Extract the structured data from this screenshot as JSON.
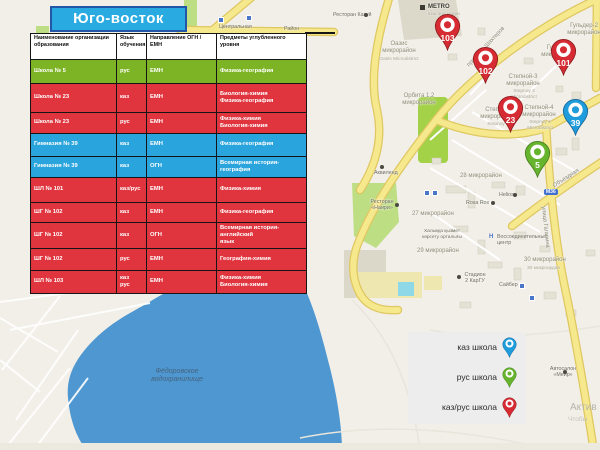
{
  "title": "Юго-восток",
  "table": {
    "headers": [
      "Наименование организации образования",
      "Язык обучения",
      "Направление ОГН /ЕМН",
      "Предметы углубленного уровня"
    ],
    "rows": [
      {
        "name": "Школа № 5",
        "lang": "рус",
        "direction": "ЕМН",
        "subjects": "Физика-география",
        "color": "green"
      },
      {
        "name": "Школа № 23",
        "lang": "каз",
        "direction": "ЕМН",
        "subjects": "Биология-химия\nФизика-география",
        "color": "red"
      },
      {
        "name": "Школа № 23",
        "lang": "рус",
        "direction": "ЕМН",
        "subjects": "Физика-химия\nБиология-химия",
        "color": "red"
      },
      {
        "name": "Гимназия № 39",
        "lang": "каз",
        "direction": "ЕМН",
        "subjects": "Физика-география",
        "color": "blue"
      },
      {
        "name": "Гимназия № 39",
        "lang": "каз",
        "direction": "ОГН",
        "subjects": "Всемирная история-география",
        "color": "blue"
      },
      {
        "name": "ШЛ № 101",
        "lang": "каз/рус",
        "direction": "ЕМН",
        "subjects": "Физика-химия",
        "color": "red"
      },
      {
        "name": "ШГ № 102",
        "lang": "каз",
        "direction": "ЕМН",
        "subjects": "Физика-география",
        "color": "red"
      },
      {
        "name": "ШГ № 102",
        "lang": "каз",
        "direction": "ОГН",
        "subjects": "Всемирная история-английский\nязык",
        "color": "red"
      },
      {
        "name": "ШГ № 102",
        "lang": "рус",
        "direction": "ЕМН",
        "subjects": "География-химия",
        "color": "red"
      },
      {
        "name": "ШЛ № 103",
        "lang": "каз\nрус",
        "direction": "ЕМН",
        "subjects": "Физика-химия\nБиология-химия",
        "color": "red"
      }
    ]
  },
  "legend": {
    "items": [
      {
        "label": "каз школа",
        "color": "blue"
      },
      {
        "label": "рус школа",
        "color": "green"
      },
      {
        "label": "каз/рус школа",
        "color": "red"
      }
    ]
  },
  "map": {
    "markers": [
      {
        "label": "103",
        "color": "red"
      },
      {
        "label": "102",
        "color": "red"
      },
      {
        "label": "101",
        "color": "red"
      },
      {
        "label": "23",
        "color": "red"
      },
      {
        "label": "39",
        "color": "blue"
      },
      {
        "label": "5",
        "color": "green"
      }
    ],
    "labels": [
      {
        "text": "Центральная"
      },
      {
        "text": "Район"
      },
      {
        "text": "Ресторан Казуй"
      },
      {
        "text": "METRO"
      },
      {
        "text": "кэш энд керри"
      },
      {
        "text": "Оазис\nмикрорайон"
      },
      {
        "text": "Oasis Microdistrict"
      },
      {
        "text": "Орбита 1,2\nмикрорайон"
      },
      {
        "text": "Гульдер-2\nмикрорайон"
      },
      {
        "text": "Гульдер\nмикрорайон"
      },
      {
        "text": "Степной-3\nмикрорайон"
      },
      {
        "text": "Stepnoy 3\nMicrodistrict"
      },
      {
        "text": "Степной-4\nмикрорайон"
      },
      {
        "text": "Stepnoy 4\nMicrodistrict"
      },
      {
        "text": "Степной\nмикрорайон"
      },
      {
        "text": "Stepnoy 2"
      },
      {
        "text": "28 микрорайон"
      },
      {
        "text": "27 микрорайон"
      },
      {
        "text": "29 микрорайон"
      },
      {
        "text": "30 микрорайон"
      },
      {
        "text": "30 микроаудан"
      },
      {
        "text": "Халыққа қызмет\nкөрсету орталығы"
      },
      {
        "text": "Воссоединительный\nцентр"
      },
      {
        "text": "Стадион\n2 КарГУ"
      },
      {
        "text": "Сайбер"
      },
      {
        "text": "Helios"
      },
      {
        "text": "Rosa Rox"
      },
      {
        "text": "Аквиленд"
      },
      {
        "text": "Ресторан\n«Наири»"
      },
      {
        "text": "Автосалон\n«Меир»"
      },
      {
        "text": "Фёдоровское\nводохранилище"
      },
      {
        "text": "Актив"
      },
      {
        "text": "Чтобы"
      },
      {
        "text": "проспект Шахтеров"
      },
      {
        "text": "Объездная"
      },
      {
        "text": "улица Гагарина"
      },
      {
        "text": "М36"
      },
      {
        "text": "Н"
      }
    ]
  },
  "colors": {
    "title_bg": "#29abe2",
    "row_green": "#7db425",
    "row_red": "#e0353f",
    "row_blue": "#29a4dc",
    "pin_red": "#d62b32",
    "pin_blue": "#1f9cdb",
    "pin_green": "#66b32e",
    "water": "#4e97d1",
    "road": "#f6e88d"
  }
}
